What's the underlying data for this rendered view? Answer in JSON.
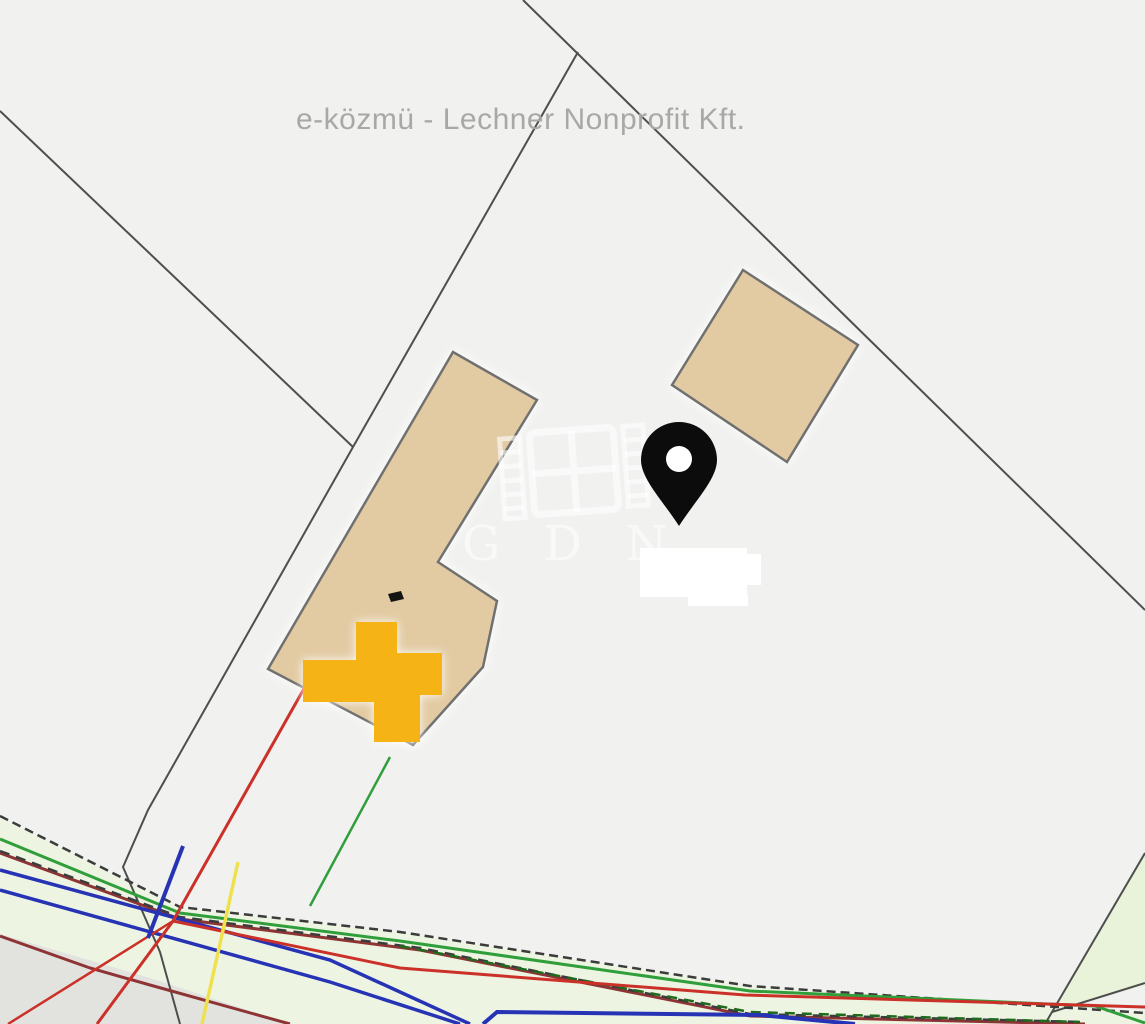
{
  "header": {
    "title": "e-közmü - Lechner Nonprofit Kft."
  },
  "watermark": {
    "letters": "G D N"
  },
  "colors": {
    "background": "#f1f1ef",
    "title_text": "#a8a8a8",
    "watermark_white": "rgba(255,255,255,0.60)",
    "parcel_line": "#4e4e4e",
    "building_fill": "#e2caa2",
    "building_stroke": "#6f6f6f",
    "building_mark": "#141414",
    "highlight_cross": "#f6b312",
    "pin_black": "#0c0c0c",
    "pin_hole": "#ffffff",
    "patch_white": "#ffffff",
    "road_zone": "#edf5e2",
    "road_zone_right": "#e9f3d9",
    "gray_zone": "#e2e2df",
    "cadastre_black": "#3c3c3c",
    "green_bright": "#2f9e3b",
    "green_dark": "#1e6b1e",
    "blue": "#2733b5",
    "red": "#cb3128",
    "dark_red": "#8e3434",
    "yellow": "#efe14e"
  }
}
